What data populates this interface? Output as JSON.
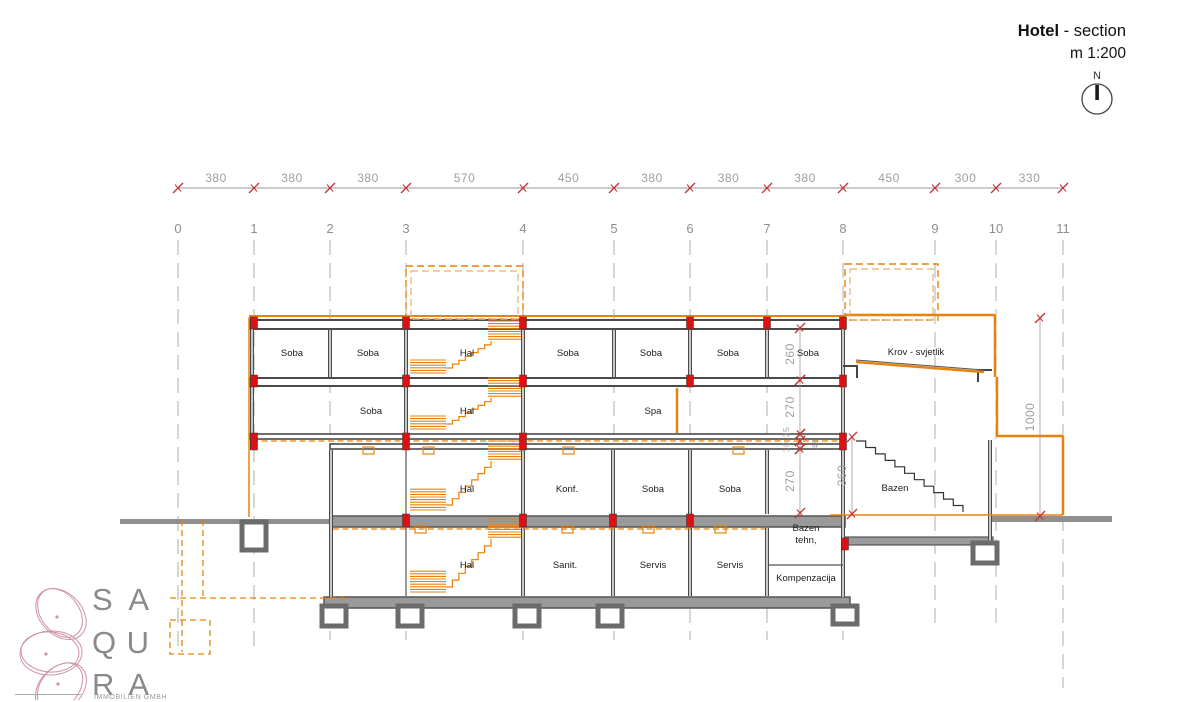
{
  "title": {
    "name": "Hotel",
    "suffix": " - section",
    "scale": "m 1:200",
    "compass_n": "N"
  },
  "logo": {
    "rows": [
      [
        "S",
        "A"
      ],
      [
        "Q",
        "U"
      ],
      [
        "R",
        "A"
      ]
    ],
    "subtext": "IMMOBILIEN GMBH"
  },
  "grid": {
    "labels": [
      "0",
      "1",
      "2",
      "3",
      "4",
      "5",
      "6",
      "7",
      "8",
      "9",
      "10",
      "11"
    ],
    "x": [
      178,
      254,
      330,
      406,
      523,
      614,
      690,
      767,
      843,
      935,
      996,
      1063
    ],
    "y_top": 240,
    "y_bottom": [
      652,
      652,
      640,
      640,
      640,
      640,
      640,
      640,
      640,
      626,
      626,
      688
    ],
    "label_y": 233
  },
  "top_dimension": {
    "y": 188,
    "values": [
      "380",
      "380",
      "380",
      "570",
      "450",
      "380",
      "380",
      "380",
      "450",
      "300",
      "330"
    ]
  },
  "vertical_dimensions": [
    {
      "label": "260",
      "x": 800,
      "y1": 328,
      "y2": 380
    },
    {
      "label": "270",
      "x": 800,
      "y1": 380,
      "y2": 434
    },
    {
      "label": "35",
      "x": 800,
      "y1": 434,
      "y2": 441,
      "small": true,
      "tx": 789,
      "ty": 432
    },
    {
      "label": "10",
      "x": 800,
      "y1": 441,
      "y2": 449,
      "small": true,
      "tx": 789,
      "ty": 447
    },
    {
      "label": "270",
      "x": 800,
      "y1": 449,
      "y2": 513
    },
    {
      "label": "48",
      "x": 818,
      "y1": 438,
      "y2": 450,
      "small": true,
      "tx": 818,
      "ty": 444,
      "noline": true
    },
    {
      "label": "360",
      "x": 852,
      "y1": 437,
      "y2": 514
    },
    {
      "label": "1000",
      "x": 1040,
      "y1": 318,
      "y2": 516
    }
  ],
  "rooms": [
    {
      "label": "Soba",
      "x": 292,
      "y": 356
    },
    {
      "label": "Soba",
      "x": 368,
      "y": 356
    },
    {
      "label": "Hal",
      "x": 467,
      "y": 356
    },
    {
      "label": "Soba",
      "x": 568,
      "y": 356
    },
    {
      "label": "Soba",
      "x": 651,
      "y": 356
    },
    {
      "label": "Soba",
      "x": 728,
      "y": 356
    },
    {
      "label": "Soba",
      "x": 808,
      "y": 356
    },
    {
      "label": "Soba",
      "x": 371,
      "y": 414
    },
    {
      "label": "Hal",
      "x": 467,
      "y": 414
    },
    {
      "label": "Spa",
      "x": 653,
      "y": 414
    },
    {
      "label": "Hal",
      "x": 467,
      "y": 492
    },
    {
      "label": "Konf.",
      "x": 567,
      "y": 492
    },
    {
      "label": "Soba",
      "x": 653,
      "y": 492
    },
    {
      "label": "Soba",
      "x": 730,
      "y": 492
    },
    {
      "label": "Hal",
      "x": 467,
      "y": 568
    },
    {
      "label": "Sanit.",
      "x": 565,
      "y": 568
    },
    {
      "label": "Servis",
      "x": 653,
      "y": 568
    },
    {
      "label": "Servis",
      "x": 730,
      "y": 568
    },
    {
      "label": "Krov - svjetlik",
      "x": 916,
      "y": 355
    },
    {
      "label": "Bazen",
      "x": 895,
      "y": 491
    },
    {
      "label": "Bazen",
      "x": 806,
      "y": 531
    },
    {
      "label": "tehn,",
      "x": 806,
      "y": 543
    },
    {
      "label": "Kompenzacija",
      "x": 806,
      "y": 581
    }
  ],
  "red_markers": [
    [
      254,
      317,
      12
    ],
    [
      406,
      317,
      12
    ],
    [
      523,
      317,
      12
    ],
    [
      690,
      317,
      12
    ],
    [
      767,
      317,
      12
    ],
    [
      843,
      317,
      12
    ],
    [
      254,
      375,
      12
    ],
    [
      406,
      375,
      12
    ],
    [
      523,
      375,
      12
    ],
    [
      690,
      375,
      12
    ],
    [
      843,
      375,
      12
    ],
    [
      254,
      433,
      17
    ],
    [
      406,
      433,
      17
    ],
    [
      523,
      433,
      17
    ],
    [
      843,
      433,
      17
    ],
    [
      406,
      514,
      13
    ],
    [
      523,
      514,
      13
    ],
    [
      613,
      514,
      13
    ],
    [
      690,
      514,
      13
    ],
    [
      845,
      538,
      12
    ]
  ],
  "colors": {
    "orange": "#E8820C",
    "orange_light": "#DFB077",
    "wall": "#4a4a4a",
    "slab_fill": "#9a9a9a",
    "red": "#DD1111",
    "tick_red": "#C23434",
    "dim_text": "#9e9e9e",
    "grid_line": "#aeaeae",
    "grid_text": "#8f8f8f",
    "room_text": "#1c1c1c"
  }
}
